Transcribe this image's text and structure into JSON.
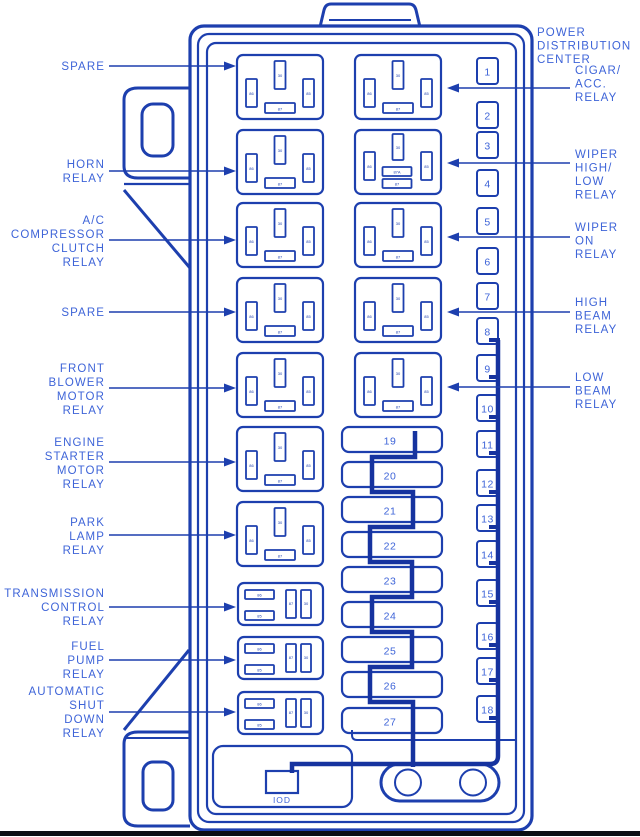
{
  "diagram": {
    "title": "POWER DISTRIBUTION CENTER",
    "colors": {
      "line": "#1d3fae",
      "thick_wire": "#16339f",
      "text": "#3e64d8",
      "background": "#ffffff",
      "baseline": "#0b0e13"
    },
    "left_labels": [
      {
        "lines": [
          "SPARE"
        ]
      },
      {
        "lines": [
          "HORN",
          "RELAY"
        ]
      },
      {
        "lines": [
          "A/C",
          "COMPRESSOR",
          "CLUTCH",
          "RELAY"
        ]
      },
      {
        "lines": [
          "SPARE"
        ]
      },
      {
        "lines": [
          "FRONT",
          "BLOWER",
          "MOTOR",
          "RELAY"
        ]
      },
      {
        "lines": [
          "ENGINE",
          "STARTER",
          "MOTOR",
          "RELAY"
        ]
      },
      {
        "lines": [
          "PARK",
          "LAMP",
          "RELAY"
        ]
      },
      {
        "lines": [
          "TRANSMISSION",
          "CONTROL",
          "RELAY"
        ]
      },
      {
        "lines": [
          "FUEL",
          "PUMP",
          "RELAY"
        ]
      },
      {
        "lines": [
          "AUTOMATIC",
          "SHUT",
          "DOWN",
          "RELAY"
        ]
      }
    ],
    "right_labels": [
      {
        "lines": [
          "POWER",
          "DISTRIBUTION",
          "CENTER"
        ]
      },
      {
        "lines": [
          "CIGAR/",
          "ACC.",
          "RELAY"
        ]
      },
      {
        "lines": [
          "WIPER",
          "HIGH/",
          "LOW",
          "RELAY"
        ]
      },
      {
        "lines": [
          "WIPER",
          "ON",
          "RELAY"
        ]
      },
      {
        "lines": [
          "HIGH",
          "BEAM",
          "RELAY"
        ]
      },
      {
        "lines": [
          "LOW",
          "BEAM",
          "RELAY"
        ]
      }
    ],
    "fuses_right": [
      "1",
      "2",
      "3",
      "4",
      "5",
      "6",
      "7",
      "8",
      "9",
      "10",
      "11",
      "12",
      "13",
      "14",
      "15",
      "16",
      "17",
      "18"
    ],
    "fuses_middle": [
      "19",
      "20",
      "21",
      "22",
      "23",
      "24",
      "25",
      "26",
      "27"
    ],
    "iod_label": "IOD",
    "relay_pins": {
      "pin30": "30",
      "pin85": "85",
      "pin86": "86",
      "pin87": "87",
      "pin87a": "87A"
    }
  }
}
